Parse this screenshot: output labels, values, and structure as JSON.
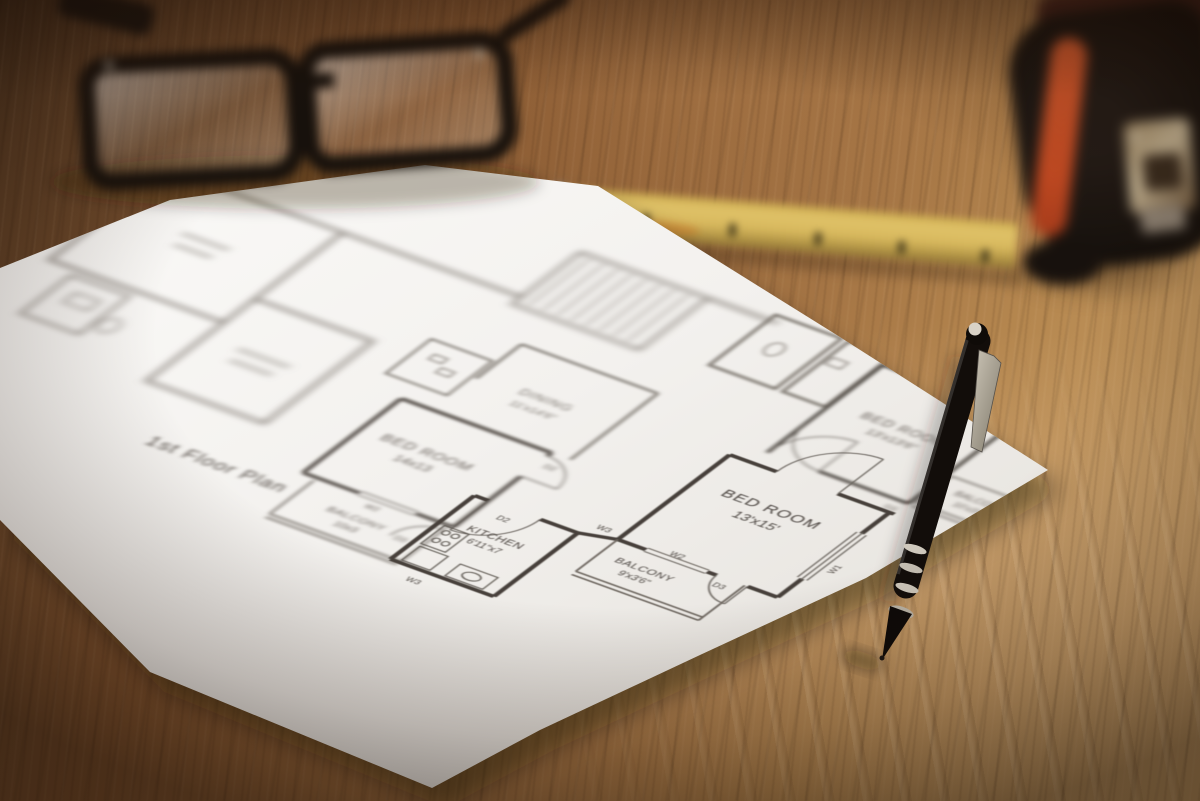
{
  "floor_plan": {
    "title": "1st Floor Plan",
    "rooms": [
      {
        "name": "BED ROOM",
        "dims": "14x13"
      },
      {
        "name": "BALCONY",
        "dims": "10x3"
      },
      {
        "name": "KITCHEN",
        "dims": "6'11\"x7"
      },
      {
        "name": "DINING",
        "dims": "11'x14'6\""
      },
      {
        "name": "BED ROOM",
        "dims": "13'x15'"
      },
      {
        "name": "BALCONY",
        "dims": "9'x3'6\""
      },
      {
        "name": "BED ROOM",
        "dims": "13'x13'6\""
      },
      {
        "name": "BALCONY",
        "dims": "10'x3'6\""
      }
    ],
    "markers": {
      "w1": "W1",
      "w2": "W2",
      "w3": "W3",
      "d2": "D2",
      "d3": "D3"
    }
  },
  "colors": {
    "wood": "#9a6c41",
    "paper": "#f4f2ef",
    "plan_ink": "#4a443e",
    "pen_body": "#15100c",
    "ruler_yellow": "#d8b95e",
    "tape_orange": "#d4502a",
    "glasses_frame": "#17110c"
  }
}
